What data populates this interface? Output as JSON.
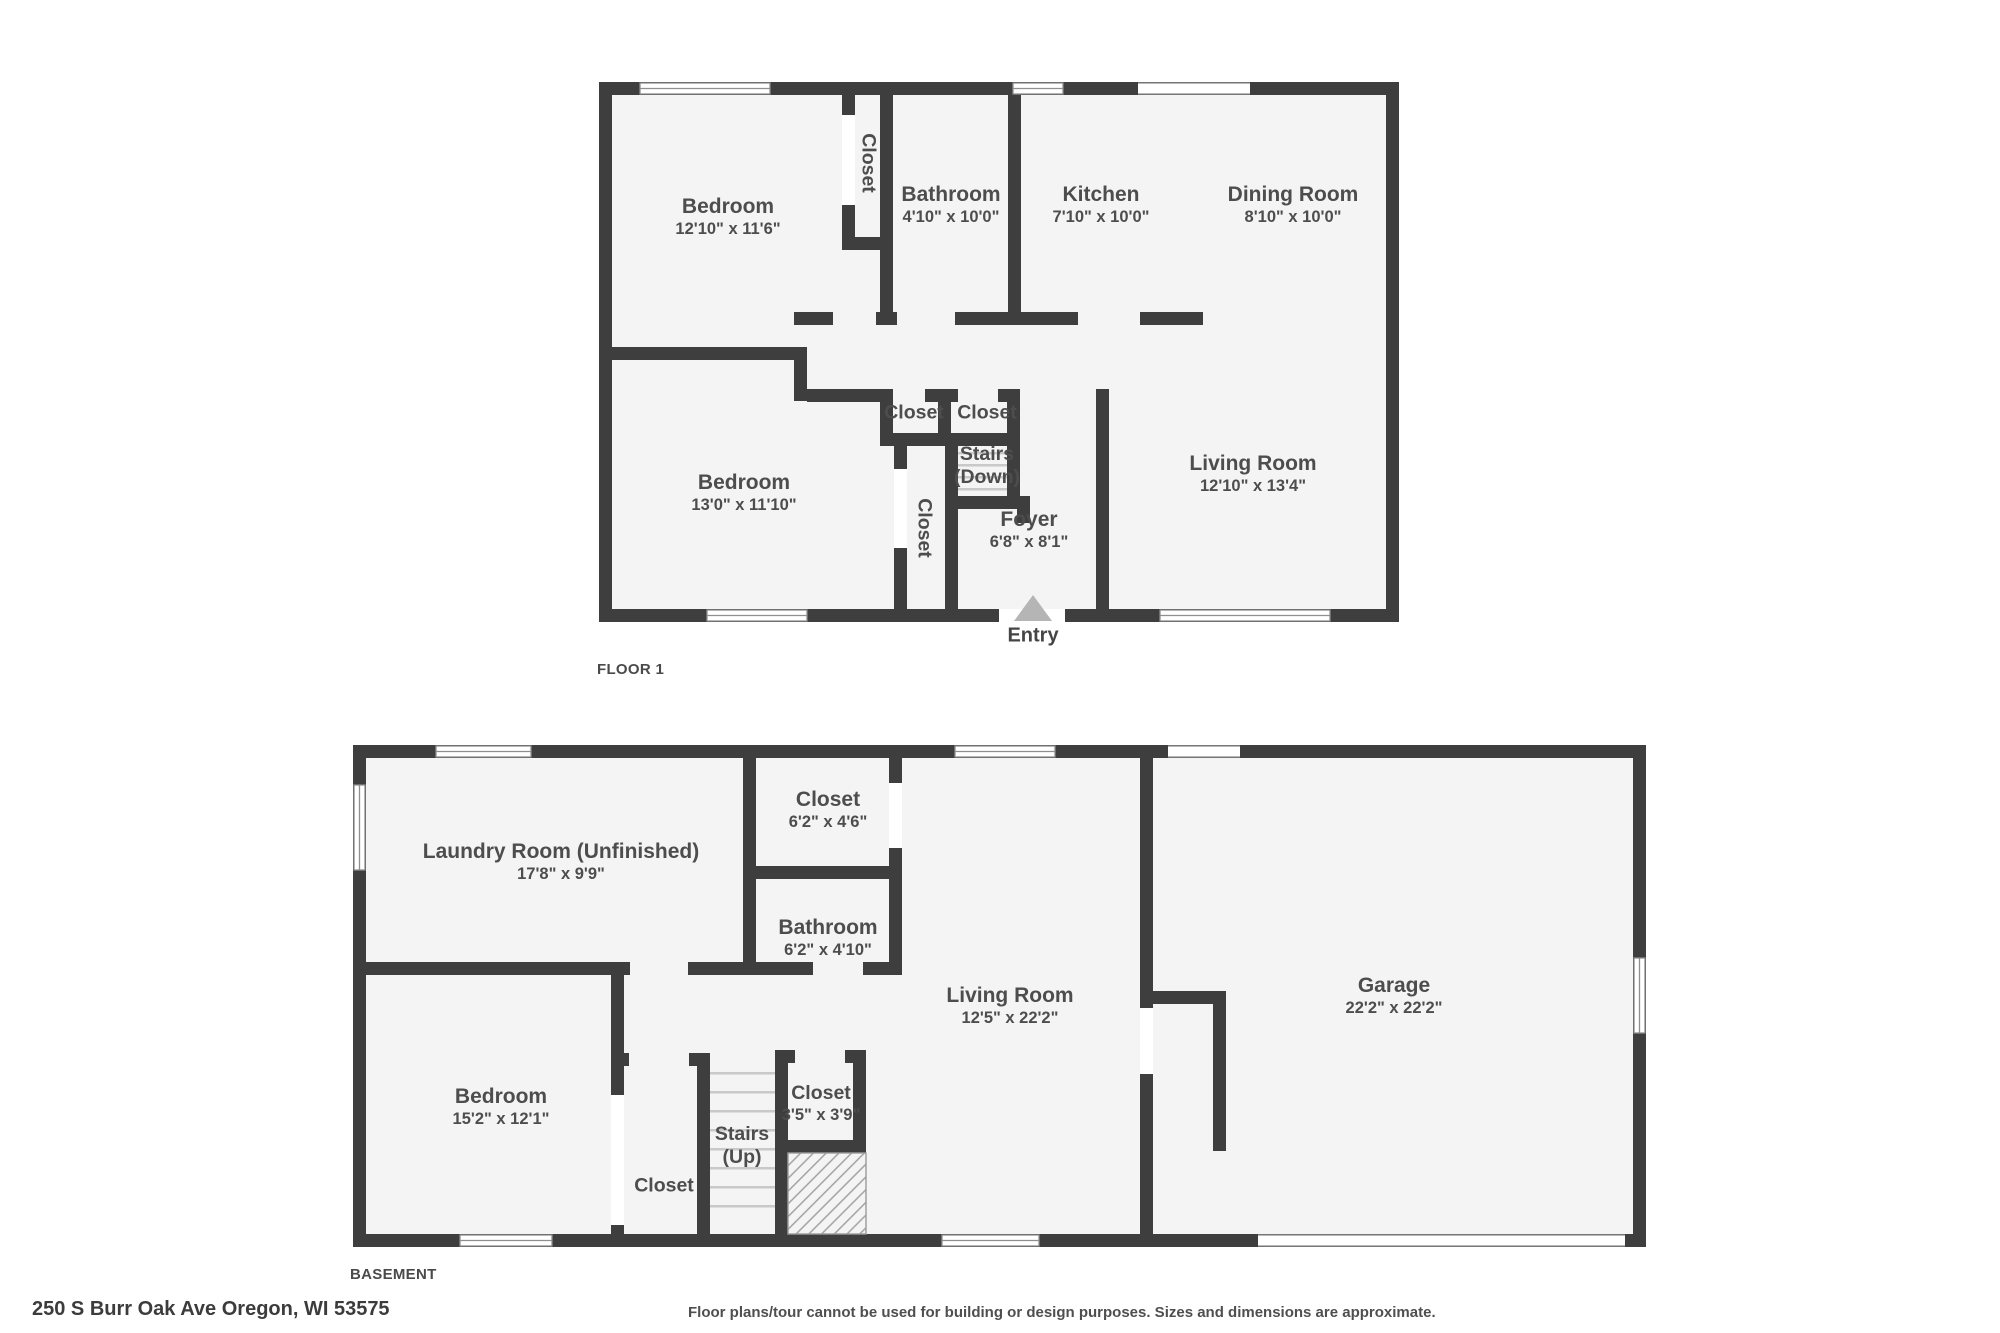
{
  "palette": {
    "wall": "#3e3e3e",
    "floor": "#f4f4f4",
    "label_text": "#4d4d4d",
    "stair_tread": "#c9c9c9",
    "window_frame": "#8f8f8f",
    "entry_arrow": "#b5b5b5",
    "hatch_line": "#9c9c9c"
  },
  "icons": {
    "entry_arrow": "triangle-up"
  },
  "floor1": {
    "label": "FLOOR 1",
    "rooms": {
      "bedroom_top": {
        "name": "Bedroom",
        "dims": "12'10\" x 11'6\""
      },
      "closet_top": {
        "name": "Closet"
      },
      "bathroom": {
        "name": "Bathroom",
        "dims": "4'10\" x 10'0\""
      },
      "kitchen": {
        "name": "Kitchen",
        "dims": "7'10\" x 10'0\""
      },
      "dining_room": {
        "name": "Dining Room",
        "dims": "8'10\" x 10'0\""
      },
      "closet_hall_left": {
        "name": "Closet"
      },
      "closet_hall_right": {
        "name": "Closet"
      },
      "stairs_down": {
        "name": "Stairs",
        "sub": "(Down)"
      },
      "closet_lower": {
        "name": "Closet"
      },
      "foyer": {
        "name": "Foyer",
        "dims": "6'8\" x 8'1\""
      },
      "bedroom_bottom": {
        "name": "Bedroom",
        "dims": "13'0\" x 11'10\""
      },
      "living_room": {
        "name": "Living Room",
        "dims": "12'10\" x 13'4\""
      },
      "entry": {
        "name": "Entry"
      }
    }
  },
  "basement": {
    "label": "BASEMENT",
    "rooms": {
      "laundry": {
        "name": "Laundry Room (Unfinished)",
        "dims": "17'8\" x 9'9\""
      },
      "closet_top": {
        "name": "Closet",
        "dims": "6'2\" x 4'6\""
      },
      "bathroom": {
        "name": "Bathroom",
        "dims": "6'2\" x 4'10\""
      },
      "living_room": {
        "name": "Living Room",
        "dims": "12'5\" x 22'2\""
      },
      "garage": {
        "name": "Garage",
        "dims": "22'2\" x 22'2\""
      },
      "bedroom": {
        "name": "Bedroom",
        "dims": "15'2\" x 12'1\""
      },
      "stairs_up": {
        "name": "Stairs",
        "sub": "(Up)"
      },
      "closet_small": {
        "name": "Closet",
        "dims": "3'5\" x 3'9\""
      },
      "closet_hall": {
        "name": "Closet"
      }
    }
  },
  "footer": {
    "address": "250 S Burr Oak Ave Oregon, WI 53575",
    "disclaimer": "Floor plans/tour cannot be used for building or design purposes. Sizes and dimensions are approximate."
  }
}
